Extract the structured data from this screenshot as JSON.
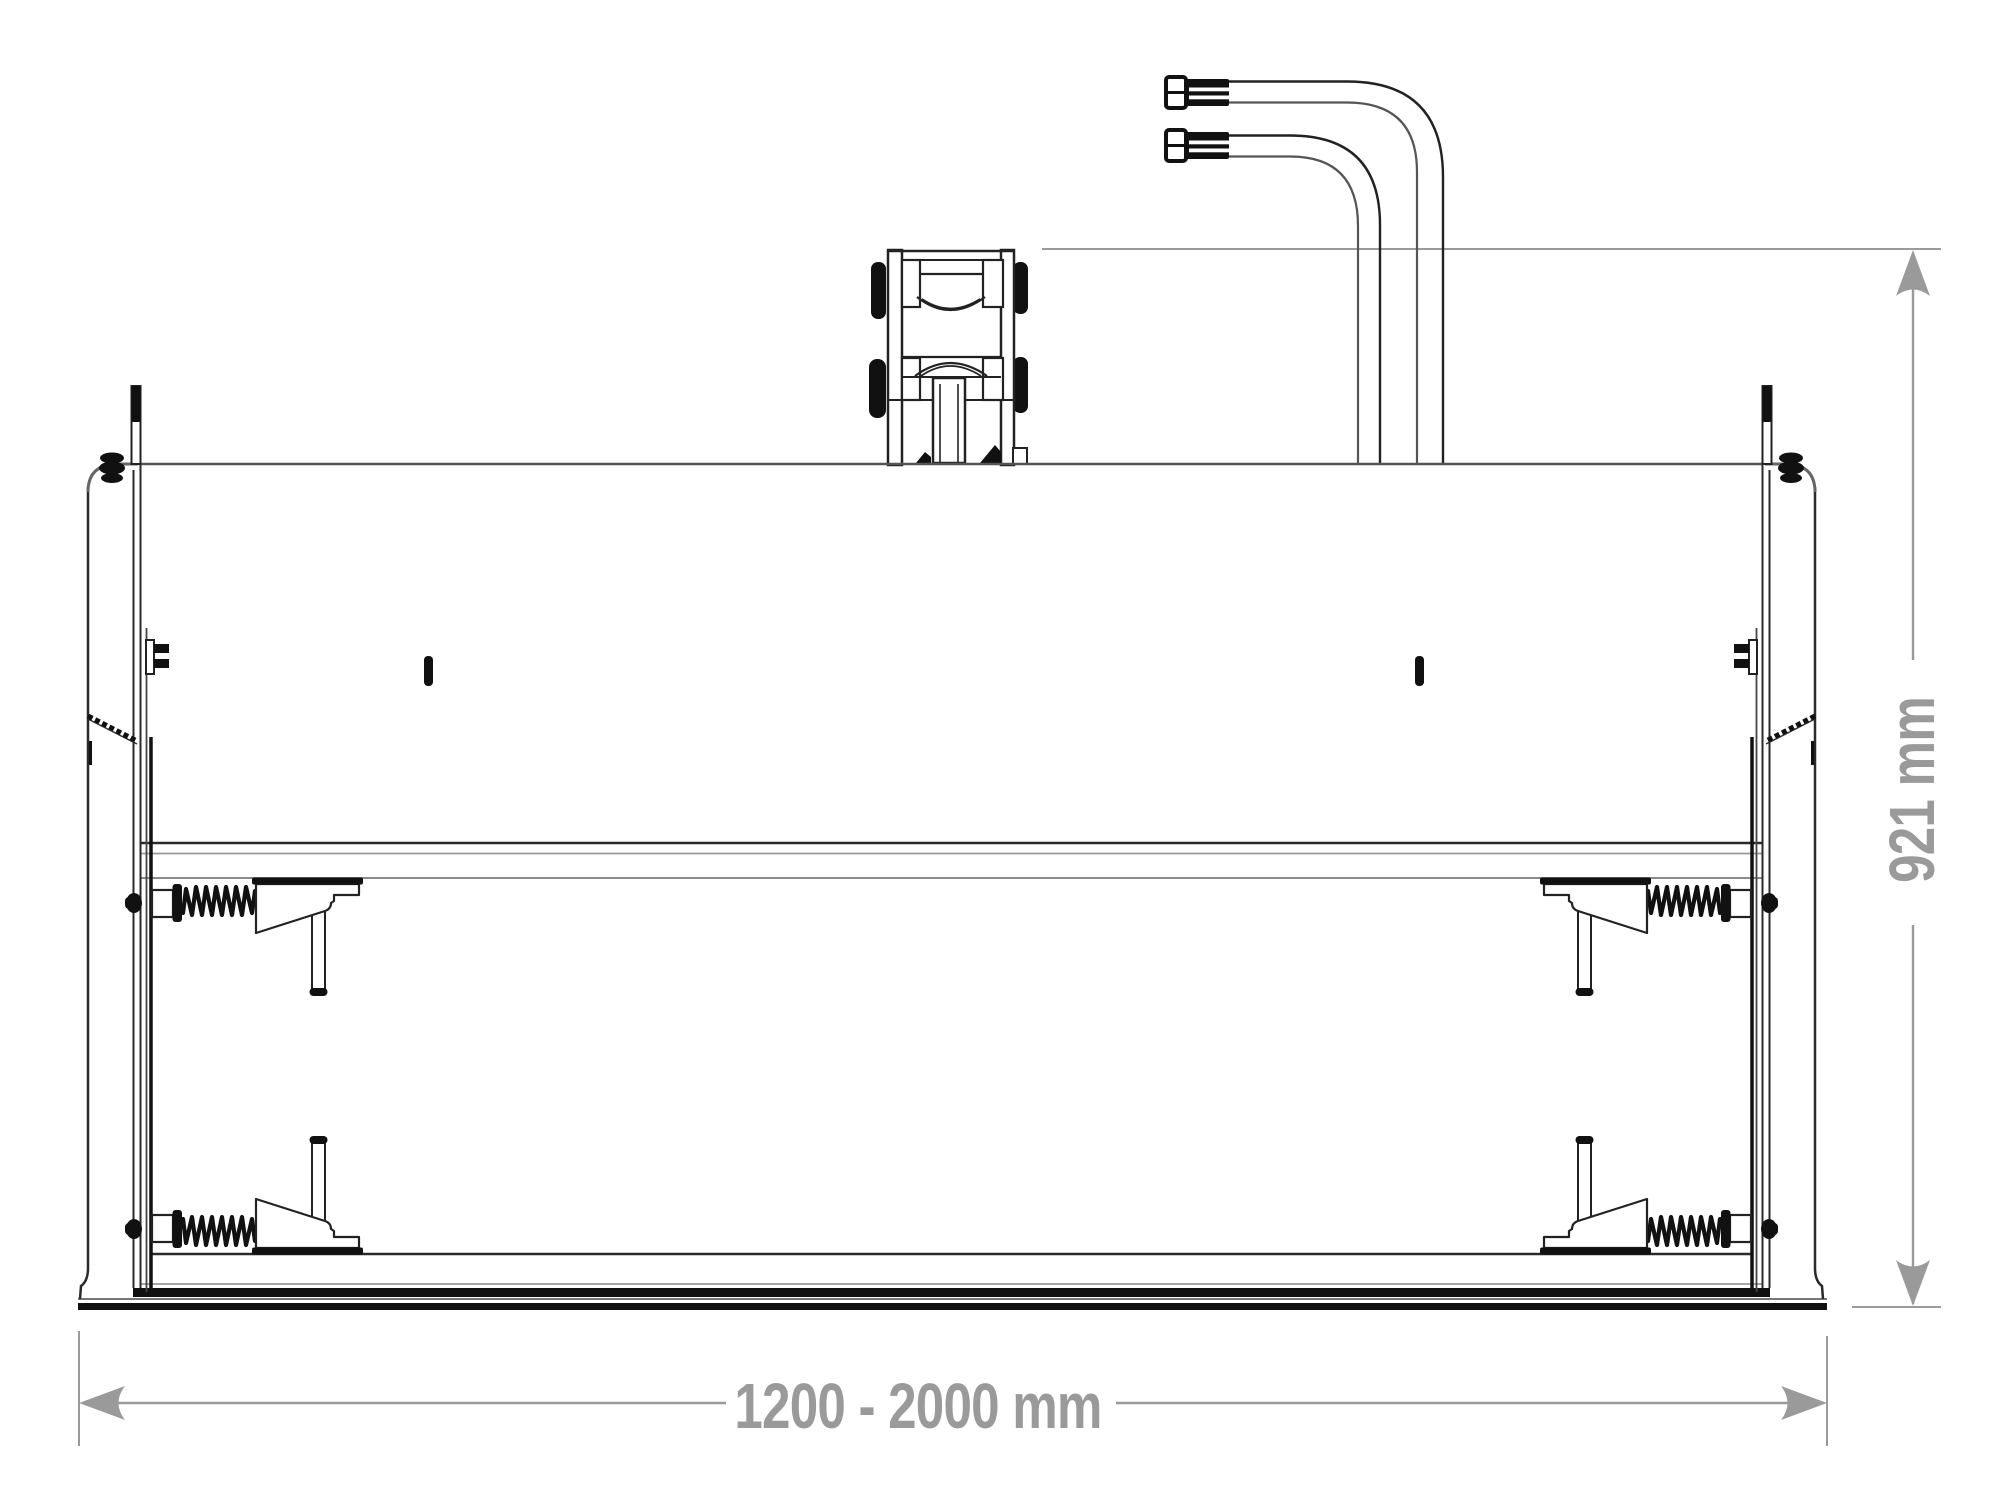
{
  "drawing": {
    "title": "front-view technical line drawing of a loader attachment (folding grab bucket) with quick-attach bracket and hydraulic hoses",
    "background_color": "#ffffff",
    "line_color": "#1f1f1f",
    "dimension_color": "#9a9a9a",
    "dimensions": {
      "height": {
        "label": "921 mm",
        "orientation": "vertical",
        "side": "right"
      },
      "width": {
        "label": "1200 - 2000 mm",
        "orientation": "horizontal",
        "side": "bottom"
      }
    },
    "parts": [
      "hydraulic-hose-coupling-upper",
      "hydraulic-hose-coupling-lower",
      "hydraulic-hoses",
      "quick-attach-bracket",
      "back-wall",
      "side-plate-left",
      "side-plate-right",
      "cross-rail",
      "latch-spring-top-left",
      "latch-spring-bottom-left",
      "latch-spring-top-right",
      "latch-spring-bottom-right",
      "locking-pins",
      "base-plate"
    ]
  }
}
